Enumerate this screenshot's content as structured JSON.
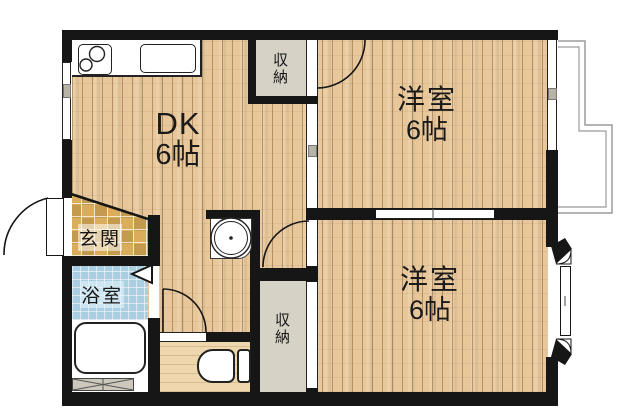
{
  "floorplan": {
    "rooms": {
      "dk": {
        "label": "DK",
        "size": "6帖"
      },
      "western_room_1": {
        "label": "洋室",
        "size": "6帖"
      },
      "western_room_2": {
        "label": "洋室",
        "size": "6帖"
      },
      "entrance": {
        "label": "玄関"
      },
      "bathroom": {
        "label": "浴室"
      },
      "closet_top": {
        "label": "収納"
      },
      "closet_bottom": {
        "label": "収納"
      }
    },
    "fixtures": {
      "stove": "stove-burners-icon",
      "kitchen_sink": "kitchen-sink-icon",
      "washbasin": "washbasin-icon",
      "bathtub": "bathtub-icon",
      "toilet": "toilet-icon",
      "washing_machine_pan": "cross-hatch-pan-icon"
    },
    "colors": {
      "wall": "#161616",
      "wood_floor": "#e8c89b",
      "wood_line": "#78522f",
      "entrance_tile": "#d9ad5c",
      "bath_tile": "#a9cfe0",
      "closet_floor": "#d6d2c6",
      "balcony_line": "#9b9b9b",
      "label_text": "#1a1a1a"
    }
  }
}
